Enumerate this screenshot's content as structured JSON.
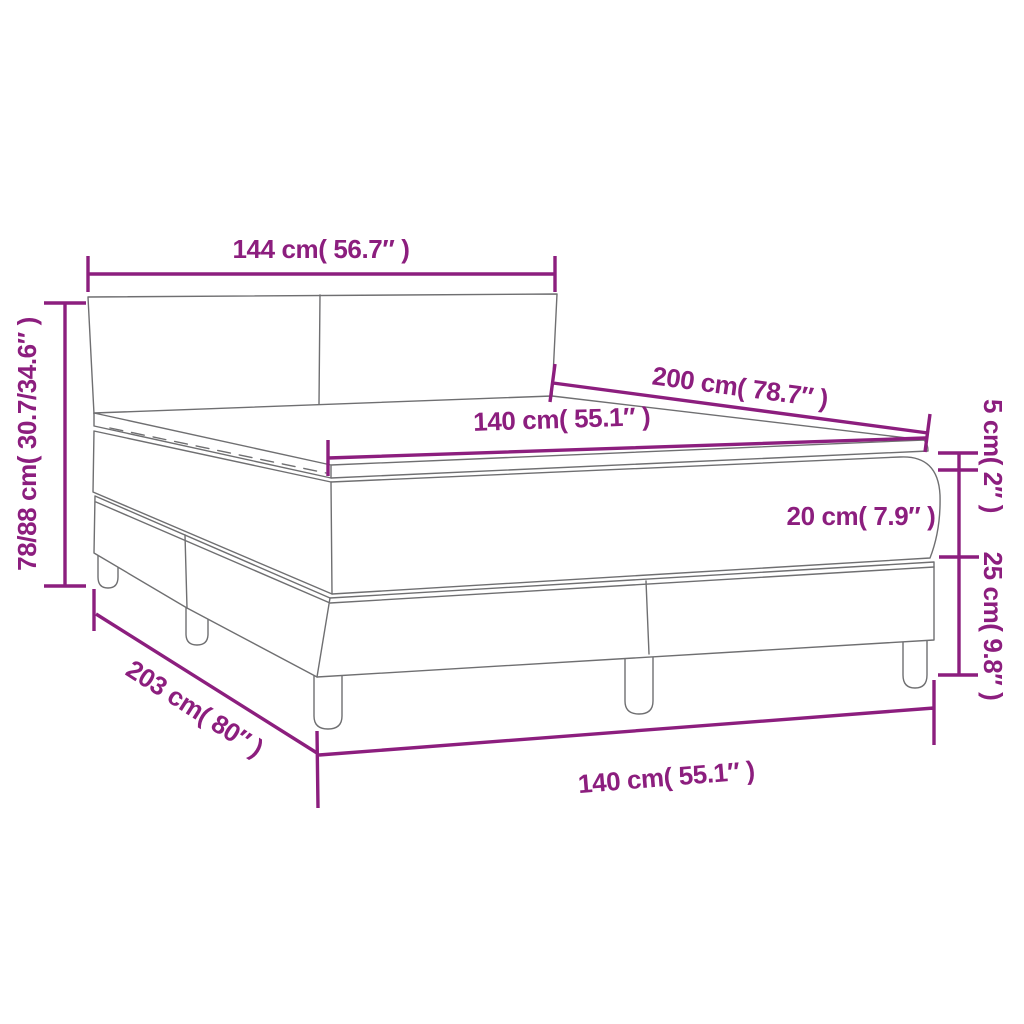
{
  "diagram": {
    "type": "furniture-dimension-diagram",
    "subject": "box spring bed with headboard, mattress and topper",
    "colors": {
      "accent": "#8C1E7E",
      "drawing_lines": "#6F6F71",
      "background": "#FFFFFF"
    },
    "dimensions": {
      "headboard_width": "144 cm( 56.7″ )",
      "height_range": "78/88 cm( 30.7/34.6″ )",
      "mattress_length": "200 cm( 78.7″ )",
      "mattress_width_top": "140 cm( 55.1″ )",
      "topper_height": "5 cm( 2″ )",
      "mattress_height": "20 cm( 7.9″ )",
      "base_height": "25 cm( 9.8″ )",
      "bed_length": "203 cm( 80″ )",
      "bed_width_bottom": "140 cm( 55.1″ )"
    }
  }
}
